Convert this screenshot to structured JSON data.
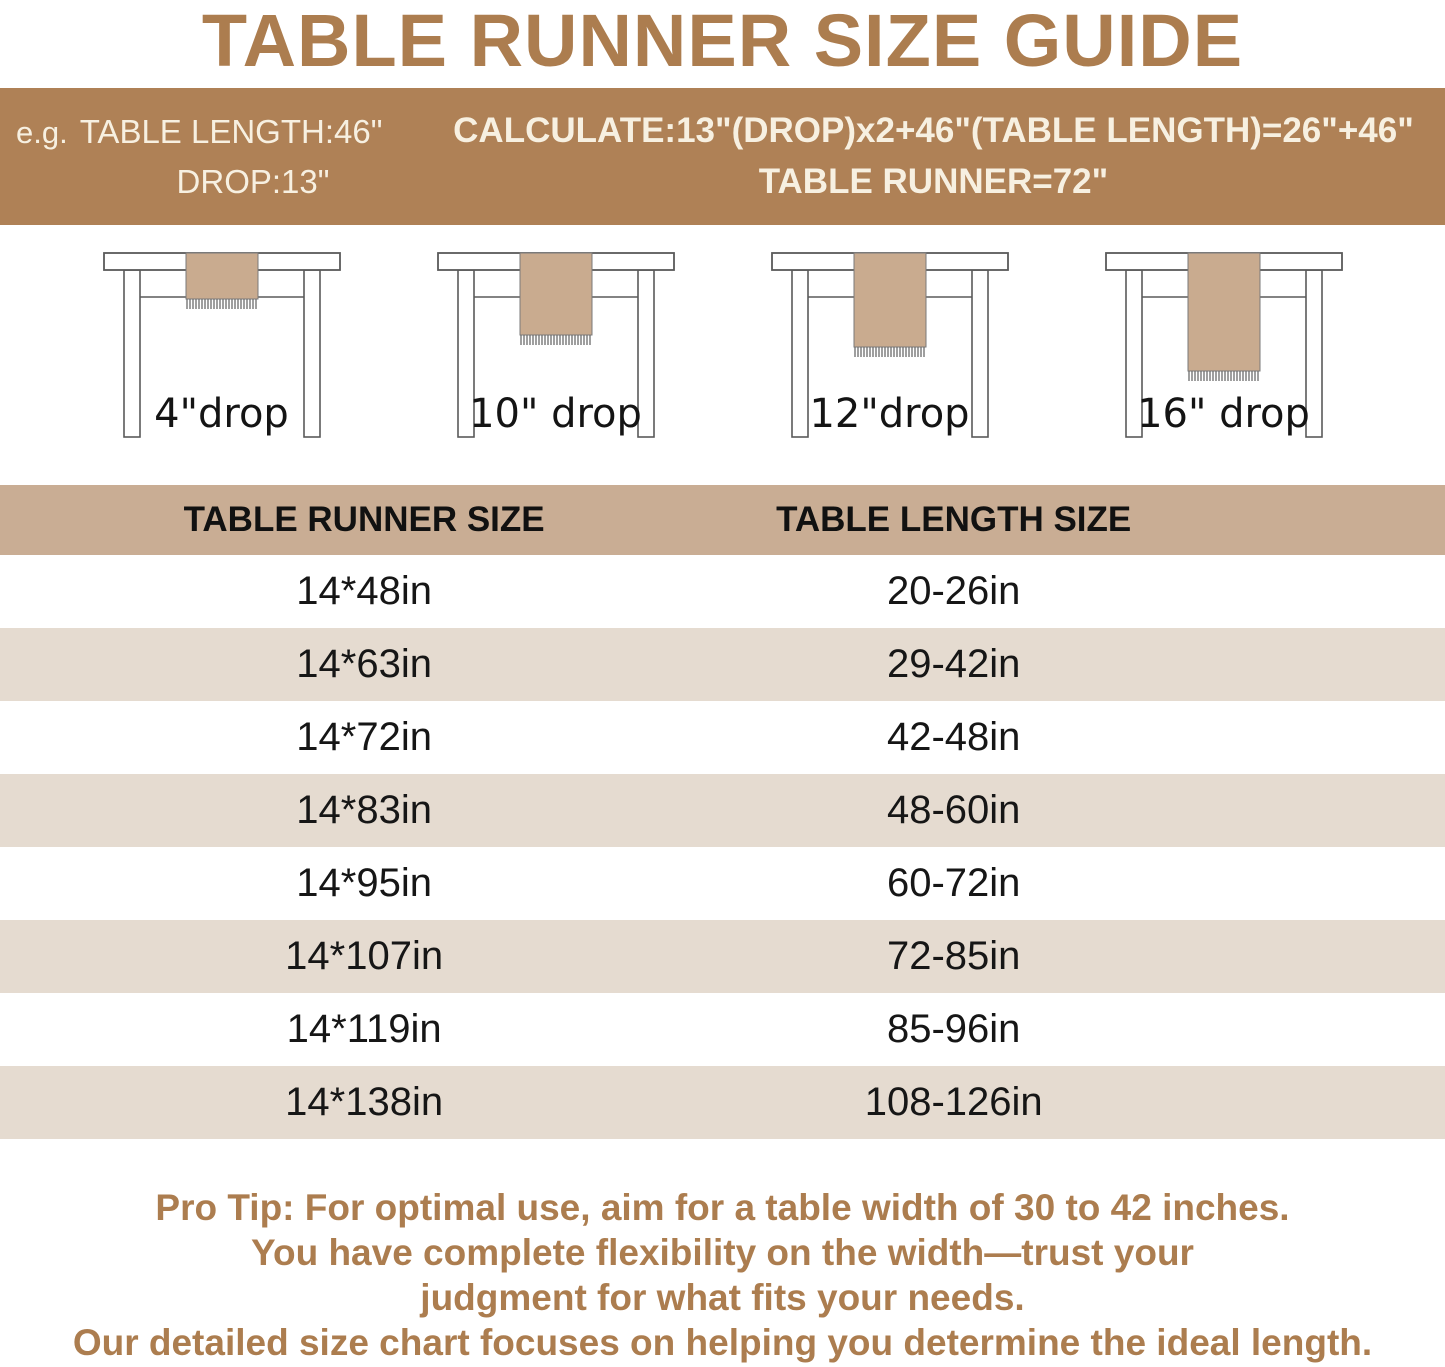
{
  "title": "TABLE RUNNER SIZE GUIDE",
  "banner": {
    "example_prefix": "e.g.",
    "example_line1": "TABLE LENGTH:46\"",
    "example_line2": "DROP:13\"",
    "calc_line1": "CALCULATE:13\"(DROP)x2+46\"(TABLE LENGTH)=26\"+46\"",
    "calc_line2": "TABLE RUNNER=72\""
  },
  "illustrations": [
    {
      "label": "4\"drop",
      "drop_in": 4
    },
    {
      "label": "10\" drop",
      "drop_in": 10
    },
    {
      "label": "12\"drop",
      "drop_in": 12
    },
    {
      "label": "16\" drop",
      "drop_in": 16
    }
  ],
  "size_table": {
    "columns": [
      "TABLE RUNNER SIZE",
      "TABLE LENGTH SIZE"
    ],
    "rows": [
      [
        "14*48in",
        "20-26in"
      ],
      [
        "14*63in",
        "29-42in"
      ],
      [
        "14*72in",
        "42-48in"
      ],
      [
        "14*83in",
        "48-60in"
      ],
      [
        "14*95in",
        "60-72in"
      ],
      [
        "14*107in",
        "72-85in"
      ],
      [
        "14*119in",
        "85-96in"
      ],
      [
        "14*138in",
        "108-126in"
      ]
    ]
  },
  "footer_lines": [
    "Pro Tip: For optimal use, aim for a table width of 30 to 42 inches.",
    "You have complete flexibility on the width—trust your",
    "judgment for what fits your needs.",
    "Our detailed size chart focuses on helping you determine the ideal length."
  ],
  "colors": {
    "brown": "#AC7D4F",
    "banner-bg": "#AF8156",
    "banner-text": "#F7F0E1",
    "header-bg": "#C9AD94",
    "alt-row-bg": "#E5DBD0",
    "row-text": "#161616",
    "runner-fill": "#C9AB8F",
    "line-color": "#5A5A5A"
  }
}
